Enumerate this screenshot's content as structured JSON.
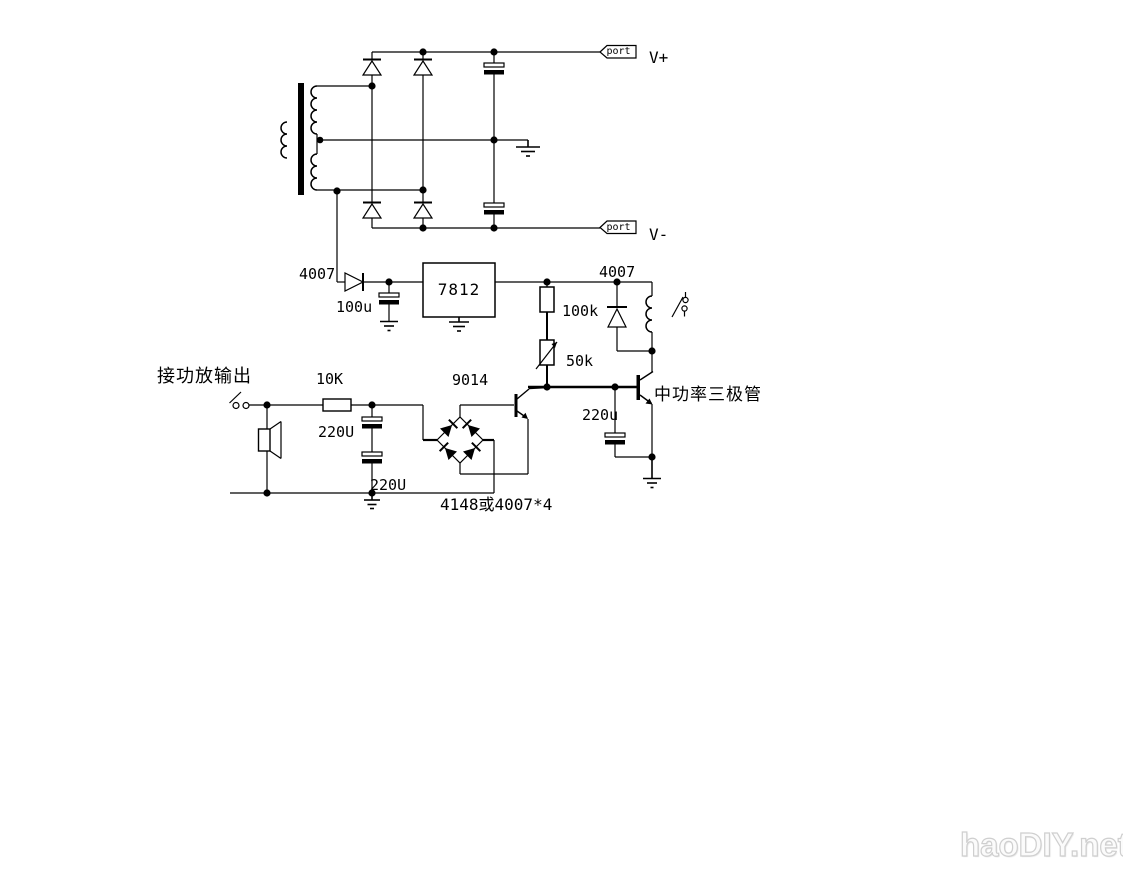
{
  "page": {
    "background": "#ffffff",
    "line_color": "#000000",
    "width": 1123,
    "height": 872
  },
  "labels": {
    "port_top": "port",
    "v_plus": "V+",
    "port_bottom": "port",
    "v_minus": "V-",
    "rectifier_diode": "4007",
    "filter_cap": "100u",
    "regulator": "7812",
    "charge_resistor": "100k",
    "freewheel_diode": "4007",
    "delay_pot": "50k",
    "input_resistor": "10K",
    "detector_transistor": "9014",
    "coupling_cap_upper": "220U",
    "coupling_cap_lower": "220U",
    "delay_cap": "220u",
    "bridge_note": "4148或4007*4",
    "input_note": "接功放输出",
    "power_transistor_note": "中功率三极管"
  },
  "watermark": {
    "text": "haoDIY.net",
    "color": "#cfcfcf"
  }
}
